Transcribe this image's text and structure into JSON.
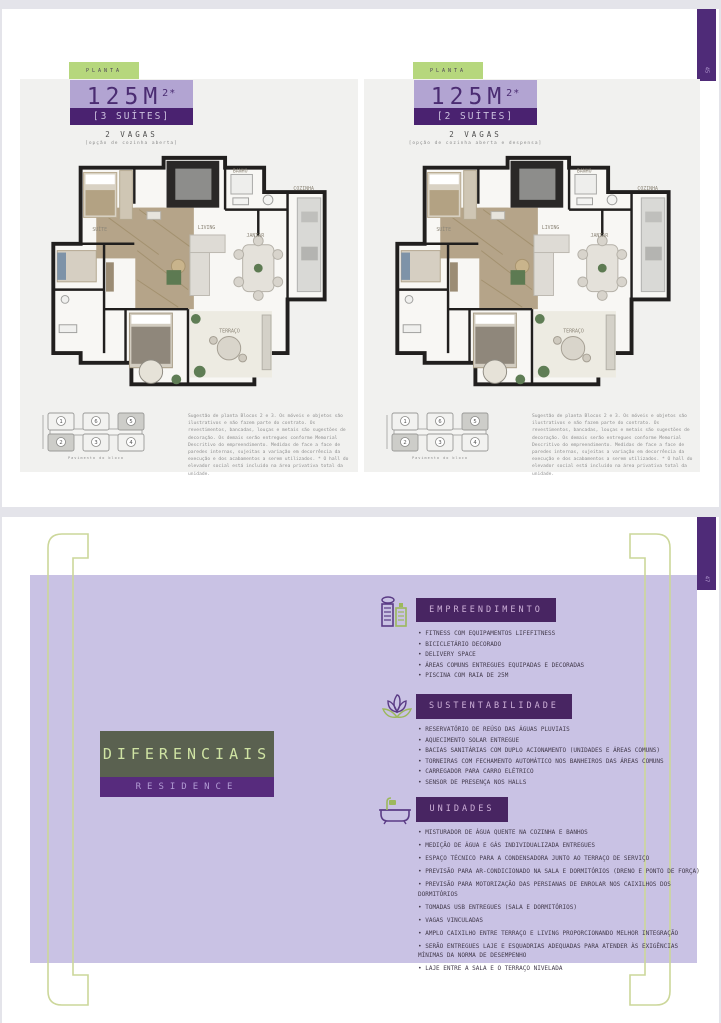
{
  "page1": {
    "tab_number": "45",
    "panels": [
      {
        "tag": "PLANTA",
        "area": "125M",
        "area_sup": "2*",
        "suites": "[3 SUÍTES]",
        "vagas": "2 VAGAS",
        "option": "[opção de cozinha aberta]"
      },
      {
        "tag": "PLANTA",
        "area": "125M",
        "area_sup": "2*",
        "suites": "[2 SUÍTES]",
        "vagas": "2 VAGAS",
        "option": "[opção de cozinha aberta e despensa]"
      }
    ],
    "keyplan": {
      "units": [
        "1",
        "6",
        "5",
        "2",
        "3",
        "4"
      ],
      "caption": "Pavimento do bloco"
    },
    "plan_labels": {
      "suite": "SUÍTE",
      "banho": "BANHO",
      "living": "LIVING",
      "jantar": "JANTAR",
      "cozinha": "COZINHA",
      "terraco": "TERRAÇO"
    },
    "disclaimer": "Sugestão de planta Blocos 2 e 3. Os móveis e objetos são ilustrativos e não fazem parte do contrato. Os revestimentos, bancadas, louças e metais são sugestões de decoração. Os demais serão entregues conforme Memorial Descritivo do empreendimento. Medidas de face a face de paredes internas, sujeitas a variação em decorrência da execução e dos acabamentos a serem utilizados. * O hall do elevador social está incluído na área privativa total da unidade."
  },
  "page2": {
    "tab_number": "47",
    "title": "DIFERENCIAIS",
    "subtitle": "RESIDENCE",
    "sections": [
      {
        "heading": "EMPREENDIMENTO",
        "icon": "buildings-icon",
        "items": [
          "FITNESS COM EQUIPAMENTOS LIFEFITNESS",
          "BICICLETÁRIO DECORADO",
          "DELIVERY SPACE",
          "ÁREAS COMUNS ENTREGUES EQUIPADAS E DECORADAS",
          "PISCINA COM RAIA DE 25M"
        ]
      },
      {
        "heading": "SUSTENTABILIDADE",
        "icon": "lotus-icon",
        "items": [
          "RESERVATÓRIO DE REÚSO DAS ÁGUAS PLUVIAIS",
          "AQUECIMENTO SOLAR ENTREGUE",
          "BACIAS SANITÁRIAS COM DUPLO ACIONAMENTO (UNIDADES E ÁREAS COMUNS)",
          "TORNEIRAS COM FECHAMENTO AUTOMÁTICO NOS BANHEIROS DAS ÁREAS COMUNS",
          "CARREGADOR PARA CARRO ELÉTRICO",
          "SENSOR DE PRESENÇA NOS HALLS"
        ]
      },
      {
        "heading": "UNIDADES",
        "icon": "bathtub-icon",
        "items": [
          "MISTURADOR DE ÁGUA QUENTE NA COZINHA E BANHOS",
          "MEDIÇÃO DE ÁGUA E GÁS INDIVIDUALIZADA ENTREGUES",
          "ESPAÇO TÉCNICO PARA A CONDENSADORA JUNTO AO TERRAÇO DE SERVIÇO",
          "PREVISÃO PARA AR-CONDICIONADO NA SALA E DORMITÓRIOS (DRENO E PONTO DE FORÇA)",
          "PREVISÃO PARA MOTORIZAÇÃO DAS PERSIANAS DE ENROLAR NOS CAIXILHOS DOS DORMITÓRIOS",
          "TOMADAS USB ENTREGUES (SALA E DORMITÓRIOS)",
          "VAGAS VINCULADAS",
          "AMPLO CAIXILHO ENTRE TERRAÇO E LIVING PROPORCIONANDO MELHOR INTEGRAÇÃO",
          "SERÃO ENTREGUES LAJE E ESQUADRIAS ADEQUADAS PARA ATENDER ÀS EXIGÊNCIAS MÍNIMAS DA NORMA DE DESEMPENHO",
          "LAJE ENTRE A SALA E O TERRAÇO NIVELADA"
        ]
      }
    ]
  },
  "colors": {
    "accent_purple": "#4a2270",
    "light_purple": "#b2a4d2",
    "lavender_bg": "#c9c2e4",
    "tag_green": "#b6d77d",
    "bracket_green": "#ccd79a",
    "olive_box": "#5a6150"
  }
}
